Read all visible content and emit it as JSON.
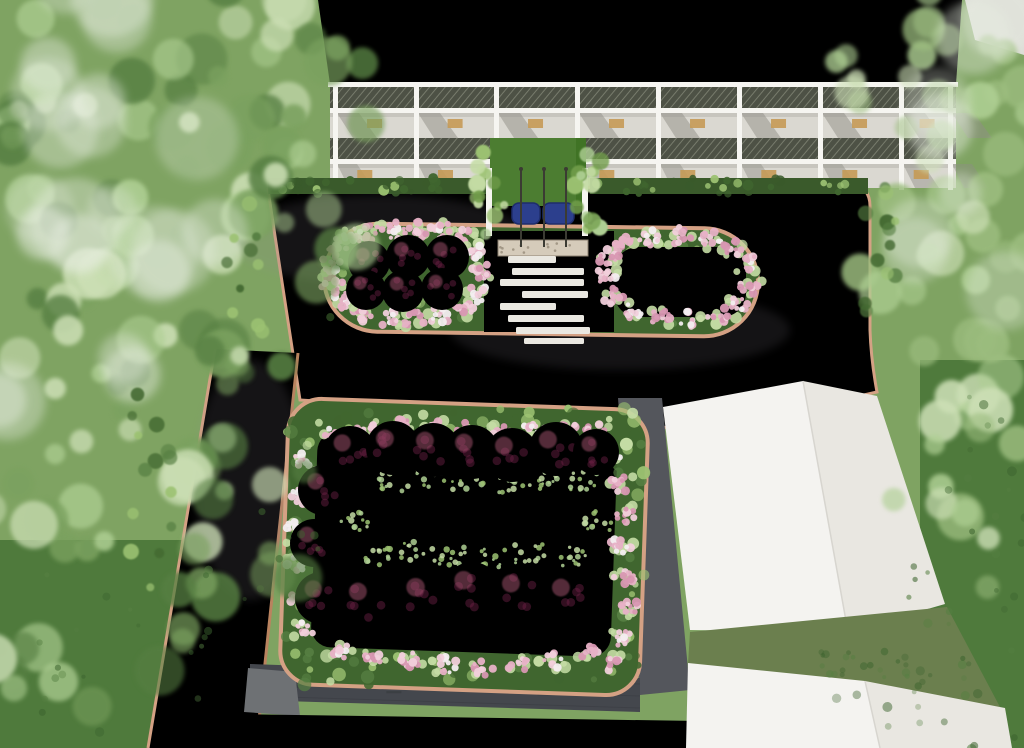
{
  "scene": {
    "title": "Aerial landscape architecture rendering",
    "description": "Top-down 3D render of a campus landscape: white multi-storey building with balcony mesh railings at top, vine-covered entrance canopy with blue shelter, gray paved plaza edged with tan brick curbs, an island planter with maroon topiary balls, white stepping-stone path and lawn ring, a large lower garden bed ringed by maroon topiary balls and pink flower borders, gray access roads, two white gable-roof buildings at lower right, and dense green tree canopies on the left and right edges."
  },
  "palette": {
    "grass_base": "#7fa362",
    "grass_dark": "#4f7a3c",
    "grass_shadow": "#3e6530",
    "gap_grass": "#6b7f4e",
    "lawn_bright": "#4b8822",
    "lawn_mid": "#3f7a1d",
    "lawn_deep": "#2f6415",
    "tree_mid": "#7aa15e",
    "tree_light": "#aecf93",
    "tree_pale": "#cde0b6",
    "tree_dark": "#567f42",
    "right_tree": "#9cbd7f",
    "haze": "#e9efe3",
    "pavement_hi": "#bab4bd",
    "pavement": "#a29aa6",
    "pavement_lo": "#8e8794",
    "curb": "#d4a184",
    "curb_dark": "#b9835f",
    "dark_path": "#54565c",
    "dark_wall": "#44474d",
    "wall_line": "#35383d",
    "roof_strip_hi": "#cecccf",
    "roof_strip": "#bfbcc2",
    "building_white": "#f2f1ed",
    "roof_light": "#edebe7",
    "roof_shade": "#e0ded8",
    "facade_wall": "#dad8d1",
    "facade_shadow": "#8f8d86",
    "mesh_dark": "#4d5145",
    "mesh_line": "#777b6c",
    "beam_white": "#f6f5f1",
    "window_tan": "#c59a55",
    "hedge": "#3a5a2b",
    "shrub_dark": "#40662f",
    "shrub_light": "#9cc272",
    "shrub_pale": "#c4dca4",
    "flower_pink": "#e7b1c6",
    "flower_pink_deep": "#d897b2",
    "flower_pink_light": "#f1cfdb",
    "flower_white": "#f3eef0",
    "topiary": "#8c3055",
    "topiary_dark": "#6f2146",
    "topiary_light": "#a85672",
    "canopy_green": "#4c7d31",
    "canopy_light": "#6f9c4a",
    "entrance_blue": "#2c3f8d",
    "entrance_blue_dark": "#1e2d6b",
    "gravel": "#d5cbba",
    "gravel_dark": "#8d8271",
    "pole": "#3b3b33",
    "stone": "#eae8e1",
    "gable_light": "#f4f3f0",
    "gable_shade": "#e9e7e1",
    "gable_edge": "#d7d5cf",
    "shingle": "#6e7174",
    "corner_path": "#dcdcd6"
  },
  "buildings": {
    "main": {
      "bays": 8,
      "mesh_bands": 2,
      "column_xs": [
        333,
        414,
        494,
        575,
        656,
        737,
        818,
        899,
        948
      ]
    },
    "gable_a": {
      "faces": 2
    },
    "gable_b": {
      "faces": 2
    }
  },
  "landscape": {
    "flagpole_xs": [
      521,
      544,
      566
    ],
    "stepping_stones": [
      [
        508,
        256,
        48,
        7
      ],
      [
        512,
        268,
        72,
        7
      ],
      [
        500,
        279,
        84,
        7
      ],
      [
        522,
        291,
        66,
        7
      ],
      [
        500,
        303,
        56,
        7
      ],
      [
        508,
        315,
        76,
        7
      ],
      [
        516,
        327,
        74,
        7
      ],
      [
        524,
        338,
        60,
        6
      ]
    ],
    "upper_planter_balls": [
      [
        369,
        262,
        21
      ],
      [
        408,
        257,
        22
      ],
      [
        447,
        257,
        22
      ],
      [
        366,
        290,
        20
      ],
      [
        403,
        291,
        21
      ],
      [
        442,
        289,
        21
      ]
    ],
    "upper_planter_flowers": [
      [
        338,
        247
      ],
      [
        354,
        236
      ],
      [
        374,
        232
      ],
      [
        396,
        230
      ],
      [
        420,
        229
      ],
      [
        444,
        231
      ],
      [
        466,
        238
      ],
      [
        478,
        252
      ],
      [
        482,
        272
      ],
      [
        478,
        294
      ],
      [
        464,
        308
      ],
      [
        440,
        316
      ],
      [
        414,
        319
      ],
      [
        388,
        318
      ],
      [
        362,
        313
      ],
      [
        342,
        300
      ],
      [
        332,
        284
      ],
      [
        332,
        264
      ]
    ],
    "lawn_ring_flowers": [
      [
        622,
        244
      ],
      [
        650,
        238
      ],
      [
        680,
        236
      ],
      [
        710,
        240
      ],
      [
        734,
        248
      ],
      [
        748,
        264
      ],
      [
        750,
        286
      ],
      [
        740,
        304
      ],
      [
        718,
        315
      ],
      [
        690,
        320
      ],
      [
        660,
        318
      ],
      [
        632,
        310
      ],
      [
        612,
        296
      ],
      [
        606,
        276
      ],
      [
        610,
        258
      ]
    ],
    "lower_garden_balls_top": [
      [
        350,
        452,
        26
      ],
      [
        393,
        448,
        27
      ],
      [
        433,
        450,
        27
      ],
      [
        472,
        452,
        27
      ],
      [
        512,
        455,
        27
      ],
      [
        556,
        449,
        27
      ],
      [
        596,
        452,
        23
      ]
    ],
    "lower_garden_balls_left": [
      [
        323,
        490,
        25
      ],
      [
        314,
        543,
        24
      ],
      [
        321,
        598,
        26
      ]
    ],
    "lower_garden_balls_bottom": [
      [
        366,
        601,
        27
      ],
      [
        424,
        597,
        28
      ],
      [
        472,
        590,
        28
      ],
      [
        519,
        593,
        27
      ],
      [
        569,
        597,
        27
      ]
    ],
    "lower_garden_flowers_top": [
      [
        335,
        436
      ],
      [
        368,
        430
      ],
      [
        401,
        427
      ],
      [
        434,
        429
      ],
      [
        467,
        431
      ],
      [
        500,
        434
      ],
      [
        534,
        430
      ],
      [
        566,
        428
      ],
      [
        596,
        431
      ]
    ],
    "lower_garden_flowers_right": [
      [
        612,
        452
      ],
      [
        621,
        483
      ],
      [
        627,
        514
      ],
      [
        621,
        546
      ],
      [
        625,
        578
      ],
      [
        631,
        609
      ],
      [
        623,
        639
      ],
      [
        615,
        664
      ]
    ],
    "lower_garden_flowers_bottom": [
      [
        589,
        655
      ],
      [
        555,
        661
      ],
      [
        519,
        665
      ],
      [
        483,
        668
      ],
      [
        447,
        664
      ],
      [
        411,
        660
      ],
      [
        375,
        656
      ],
      [
        343,
        649
      ]
    ],
    "lower_garden_flowers_left": [
      [
        303,
        462
      ],
      [
        298,
        496
      ],
      [
        296,
        530
      ],
      [
        297,
        564
      ],
      [
        300,
        597
      ],
      [
        306,
        629
      ]
    ],
    "lower_garden_sprigs": [
      [
        392,
        481
      ],
      [
        430,
        477
      ],
      [
        468,
        480
      ],
      [
        506,
        483
      ],
      [
        544,
        479
      ],
      [
        582,
        482
      ],
      [
        380,
        556
      ],
      [
        418,
        552
      ],
      [
        456,
        555
      ],
      [
        494,
        558
      ],
      [
        532,
        554
      ],
      [
        570,
        557
      ],
      [
        600,
        520
      ],
      [
        352,
        520
      ]
    ]
  },
  "vegetation": {
    "left_tree_zones": [
      [
        150,
        70,
        210,
        110,
        26
      ],
      [
        60,
        220,
        150,
        150,
        22
      ],
      [
        190,
        290,
        150,
        120,
        18
      ],
      [
        90,
        420,
        170,
        150,
        22
      ],
      [
        200,
        520,
        140,
        110,
        16
      ],
      [
        60,
        610,
        130,
        110,
        16
      ],
      [
        280,
        90,
        100,
        80,
        12
      ],
      [
        300,
        210,
        70,
        90,
        10
      ]
    ],
    "left_haze_zones": [
      [
        90,
        60,
        160,
        90,
        8
      ],
      [
        40,
        300,
        120,
        160,
        8
      ],
      [
        150,
        200,
        120,
        90,
        6
      ]
    ],
    "right_tree_zones": [
      [
        965,
        60,
        120,
        100,
        16
      ],
      [
        995,
        180,
        90,
        110,
        12
      ],
      [
        955,
        290,
        100,
        110,
        12
      ],
      [
        990,
        410,
        80,
        100,
        10
      ],
      [
        965,
        515,
        90,
        90,
        10
      ],
      [
        920,
        50,
        90,
        70,
        8
      ]
    ],
    "right_haze_zones": [
      [
        1000,
        80,
        90,
        70,
        5
      ],
      [
        980,
        260,
        70,
        90,
        4
      ]
    ],
    "dark_grass_zones": [
      [
        980,
        640,
        90,
        110,
        30
      ],
      [
        990,
        480,
        60,
        90,
        16
      ],
      [
        80,
        660,
        140,
        90,
        26
      ],
      [
        260,
        560,
        60,
        60,
        10
      ],
      [
        900,
        700,
        80,
        50,
        12
      ]
    ],
    "shrub_line_zones": [
      [
        150,
        500,
        30,
        120,
        14
      ],
      [
        248,
        270,
        24,
        80,
        10
      ],
      [
        880,
        260,
        18,
        90,
        12
      ]
    ],
    "canopy_vine_zones": [
      [
        489,
        195,
        16,
        48,
        14
      ],
      [
        590,
        195,
        16,
        48,
        14
      ]
    ],
    "hedge_rects": [
      [
        268,
        178,
        218,
        16,
        26
      ],
      [
        590,
        178,
        278,
        16,
        32
      ]
    ],
    "garden_border_rects": [
      [
        290,
        408,
        350,
        26,
        34
      ],
      [
        300,
        652,
        330,
        34,
        32
      ],
      [
        286,
        420,
        26,
        260,
        26
      ],
      [
        618,
        430,
        26,
        250,
        26
      ]
    ],
    "planter_border_rects": [
      [
        330,
        230,
        150,
        100,
        30
      ],
      [
        606,
        244,
        150,
        84,
        24
      ]
    ],
    "gap_grass_dots": [
      [
        820,
        650,
        130,
        28,
        18
      ]
    ]
  }
}
